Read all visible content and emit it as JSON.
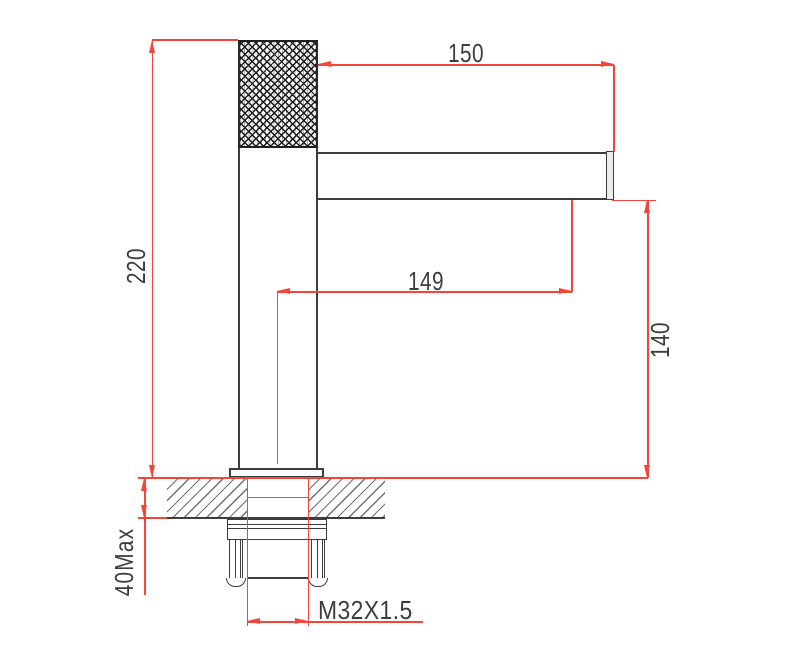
{
  "drawing": {
    "kind": "faucet-installation-technical-drawing",
    "labels": {
      "spout_length": "150",
      "overall_height": "220",
      "spout_reach": "149",
      "outlet_height": "140",
      "max_deck_thickness": "40Max",
      "thread_size": "M32X1.5"
    },
    "colors": {
      "red": "#f54438",
      "ink": "#3d3d3d",
      "hatch": "#707070",
      "knurl": "#1c1c1c"
    }
  }
}
